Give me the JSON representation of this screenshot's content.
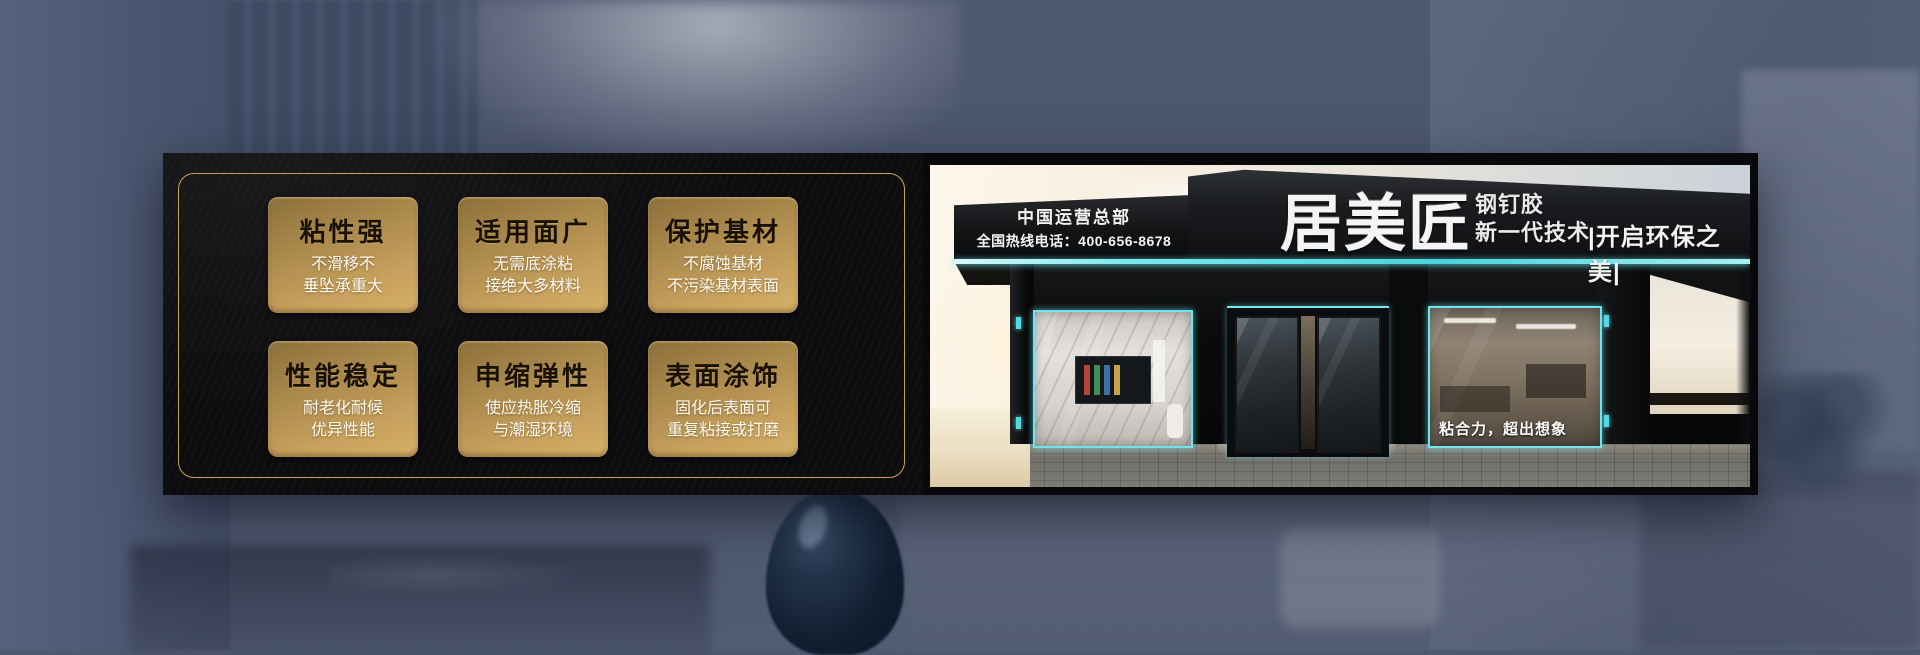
{
  "banner": {
    "features": [
      {
        "title": "粘性强",
        "line1": "不滑移不",
        "line2": "垂坠承重大"
      },
      {
        "title": "适用面广",
        "line1": "无需底涂粘",
        "line2": "接绝大多材料"
      },
      {
        "title": "保护基材",
        "line1": "不腐蚀基材",
        "line2": "不污染基材表面"
      },
      {
        "title": "性能稳定",
        "line1": "耐老化耐候",
        "line2": "优异性能"
      },
      {
        "title": "申缩弹性",
        "line1": "使应热胀冷缩",
        "line2": "与潮湿环境"
      },
      {
        "title": "表面涂饰",
        "line1": "固化后表面可",
        "line2": "重复粘接或打磨"
      }
    ],
    "storefront": {
      "hq": "中国运营总部",
      "hotline": "全国热线电话：400-656-8678",
      "brand": "居美匠",
      "product_line1": "钢钉胶",
      "product_line2": "新一代技术",
      "right_slogan": "|开启环保之美|",
      "window_slogan": "粘合力，超出想象"
    },
    "colors": {
      "gold_border": "#c9a25c",
      "card_gold_top": "#8c6f3a",
      "card_gold_bottom": "#d6b169",
      "cyan_accent": "#67e1ea",
      "panel_black": "#0d0d10"
    }
  }
}
